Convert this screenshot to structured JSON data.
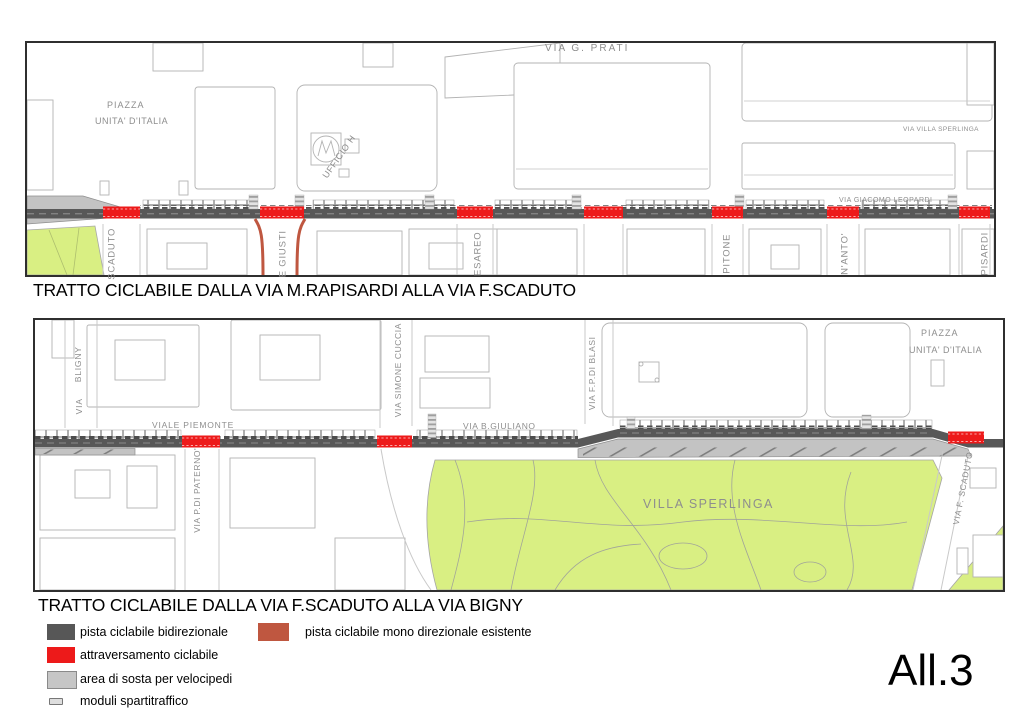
{
  "sheet": {
    "annex_label": "All.3"
  },
  "map1": {
    "title": "TRATTO CICLABILE DALLA VIA M.RAPISARDI ALLA VIA F.SCADUTO",
    "labels": {
      "piazza_line1": "PIAZZA",
      "piazza_line2": "UNITA' D'ITALIA",
      "ufficio_h": "UFFICIO H",
      "via_g_prati": "VIA  G. PRATI",
      "via_villa_sperlinga": "VIA VILLA SPERLINGA",
      "via_giacomo_leopardi": "VIA GIACOMO LEOPARDI",
      "street_scaduto": "SCADUTO",
      "street_giusti": "E GIUSTI",
      "street_cesareo": "ESAREO",
      "street_pitone": "PITONE",
      "street_santanto": "N'ANTO'",
      "street_rapisardi": "PISARDI"
    }
  },
  "map2": {
    "title": "TRATTO CICLABILE DALLA VIA F.SCADUTO ALLA VIA BIGNY",
    "labels": {
      "street_bligny_line1": "BLIGNY",
      "street_bligny_line2": "VIA",
      "viale_piemonte": "VIALE PIEMONTE",
      "via_pdi_paterno": "VIA P.DI PATERNO'",
      "via_simone_cuccia": "VIA SIMONE CUCCIA",
      "via_b_giuliano": "VIA B.GIULIANO",
      "via_fp_di_blasi": "VIA F.P.DI BLASI",
      "villa_sperlinga": "VILLA SPERLINGA",
      "piazza_line1": "PIAZZA",
      "piazza_line2": "UNITA' D'ITALIA",
      "via_f_scaduto": "VIA F. SCADUTO"
    }
  },
  "legend": {
    "items": [
      {
        "label": "pista ciclabile bidirezionale",
        "color": "#575757"
      },
      {
        "label": "attraversamento  ciclabile",
        "color": "#ed1a1a"
      },
      {
        "label": "area di sosta per velocipedi",
        "color": "#c6c6c6"
      },
      {
        "label": "moduli spartitraffico",
        "color": "#dedede"
      },
      {
        "label": "pista ciclabile mono direzionale esistente",
        "color": "#bf5740"
      }
    ]
  },
  "colors": {
    "cycle_path_bidirectional": "#585858",
    "cycle_crossing": "#ed1a1a",
    "bike_parking_area": "#c3c3c3",
    "traffic_modules": "#4c4c4c",
    "existing_mono_path": "#bf5740",
    "green_area": "#d9ef83"
  }
}
